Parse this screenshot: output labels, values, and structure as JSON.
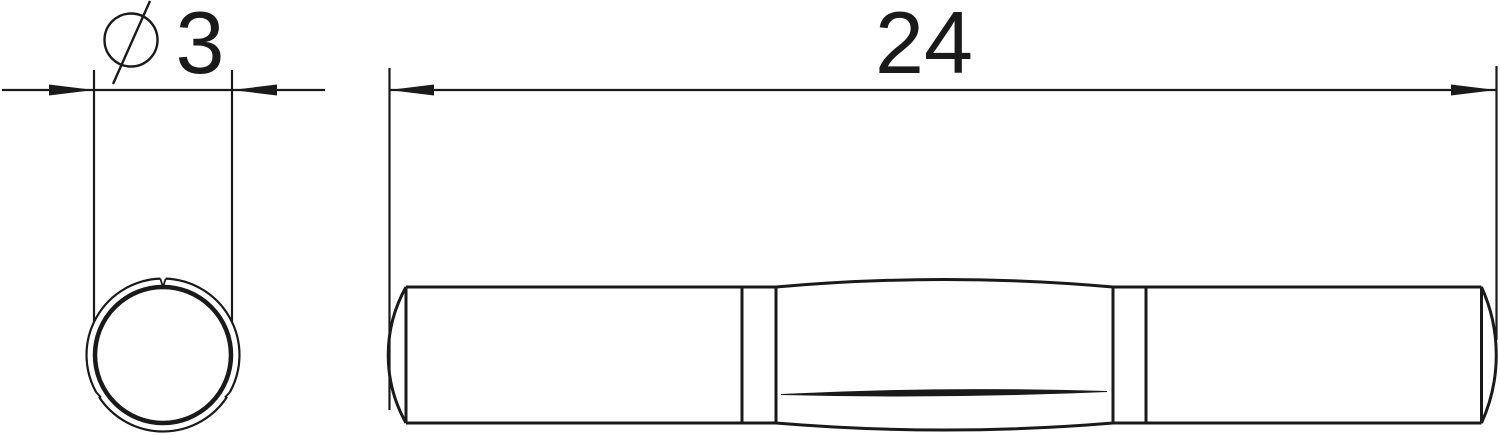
{
  "page": {
    "background_color": "#ffffff",
    "line_color": "#1a1a1a"
  },
  "drawing": {
    "kind": "technical-dimension-drawing",
    "views": {
      "end_view": {
        "dimension": {
          "symbol": "⌀",
          "value": "3",
          "label": "⌀3"
        }
      },
      "side_view": {
        "dimension": {
          "value": "24",
          "label": "24"
        }
      }
    }
  }
}
